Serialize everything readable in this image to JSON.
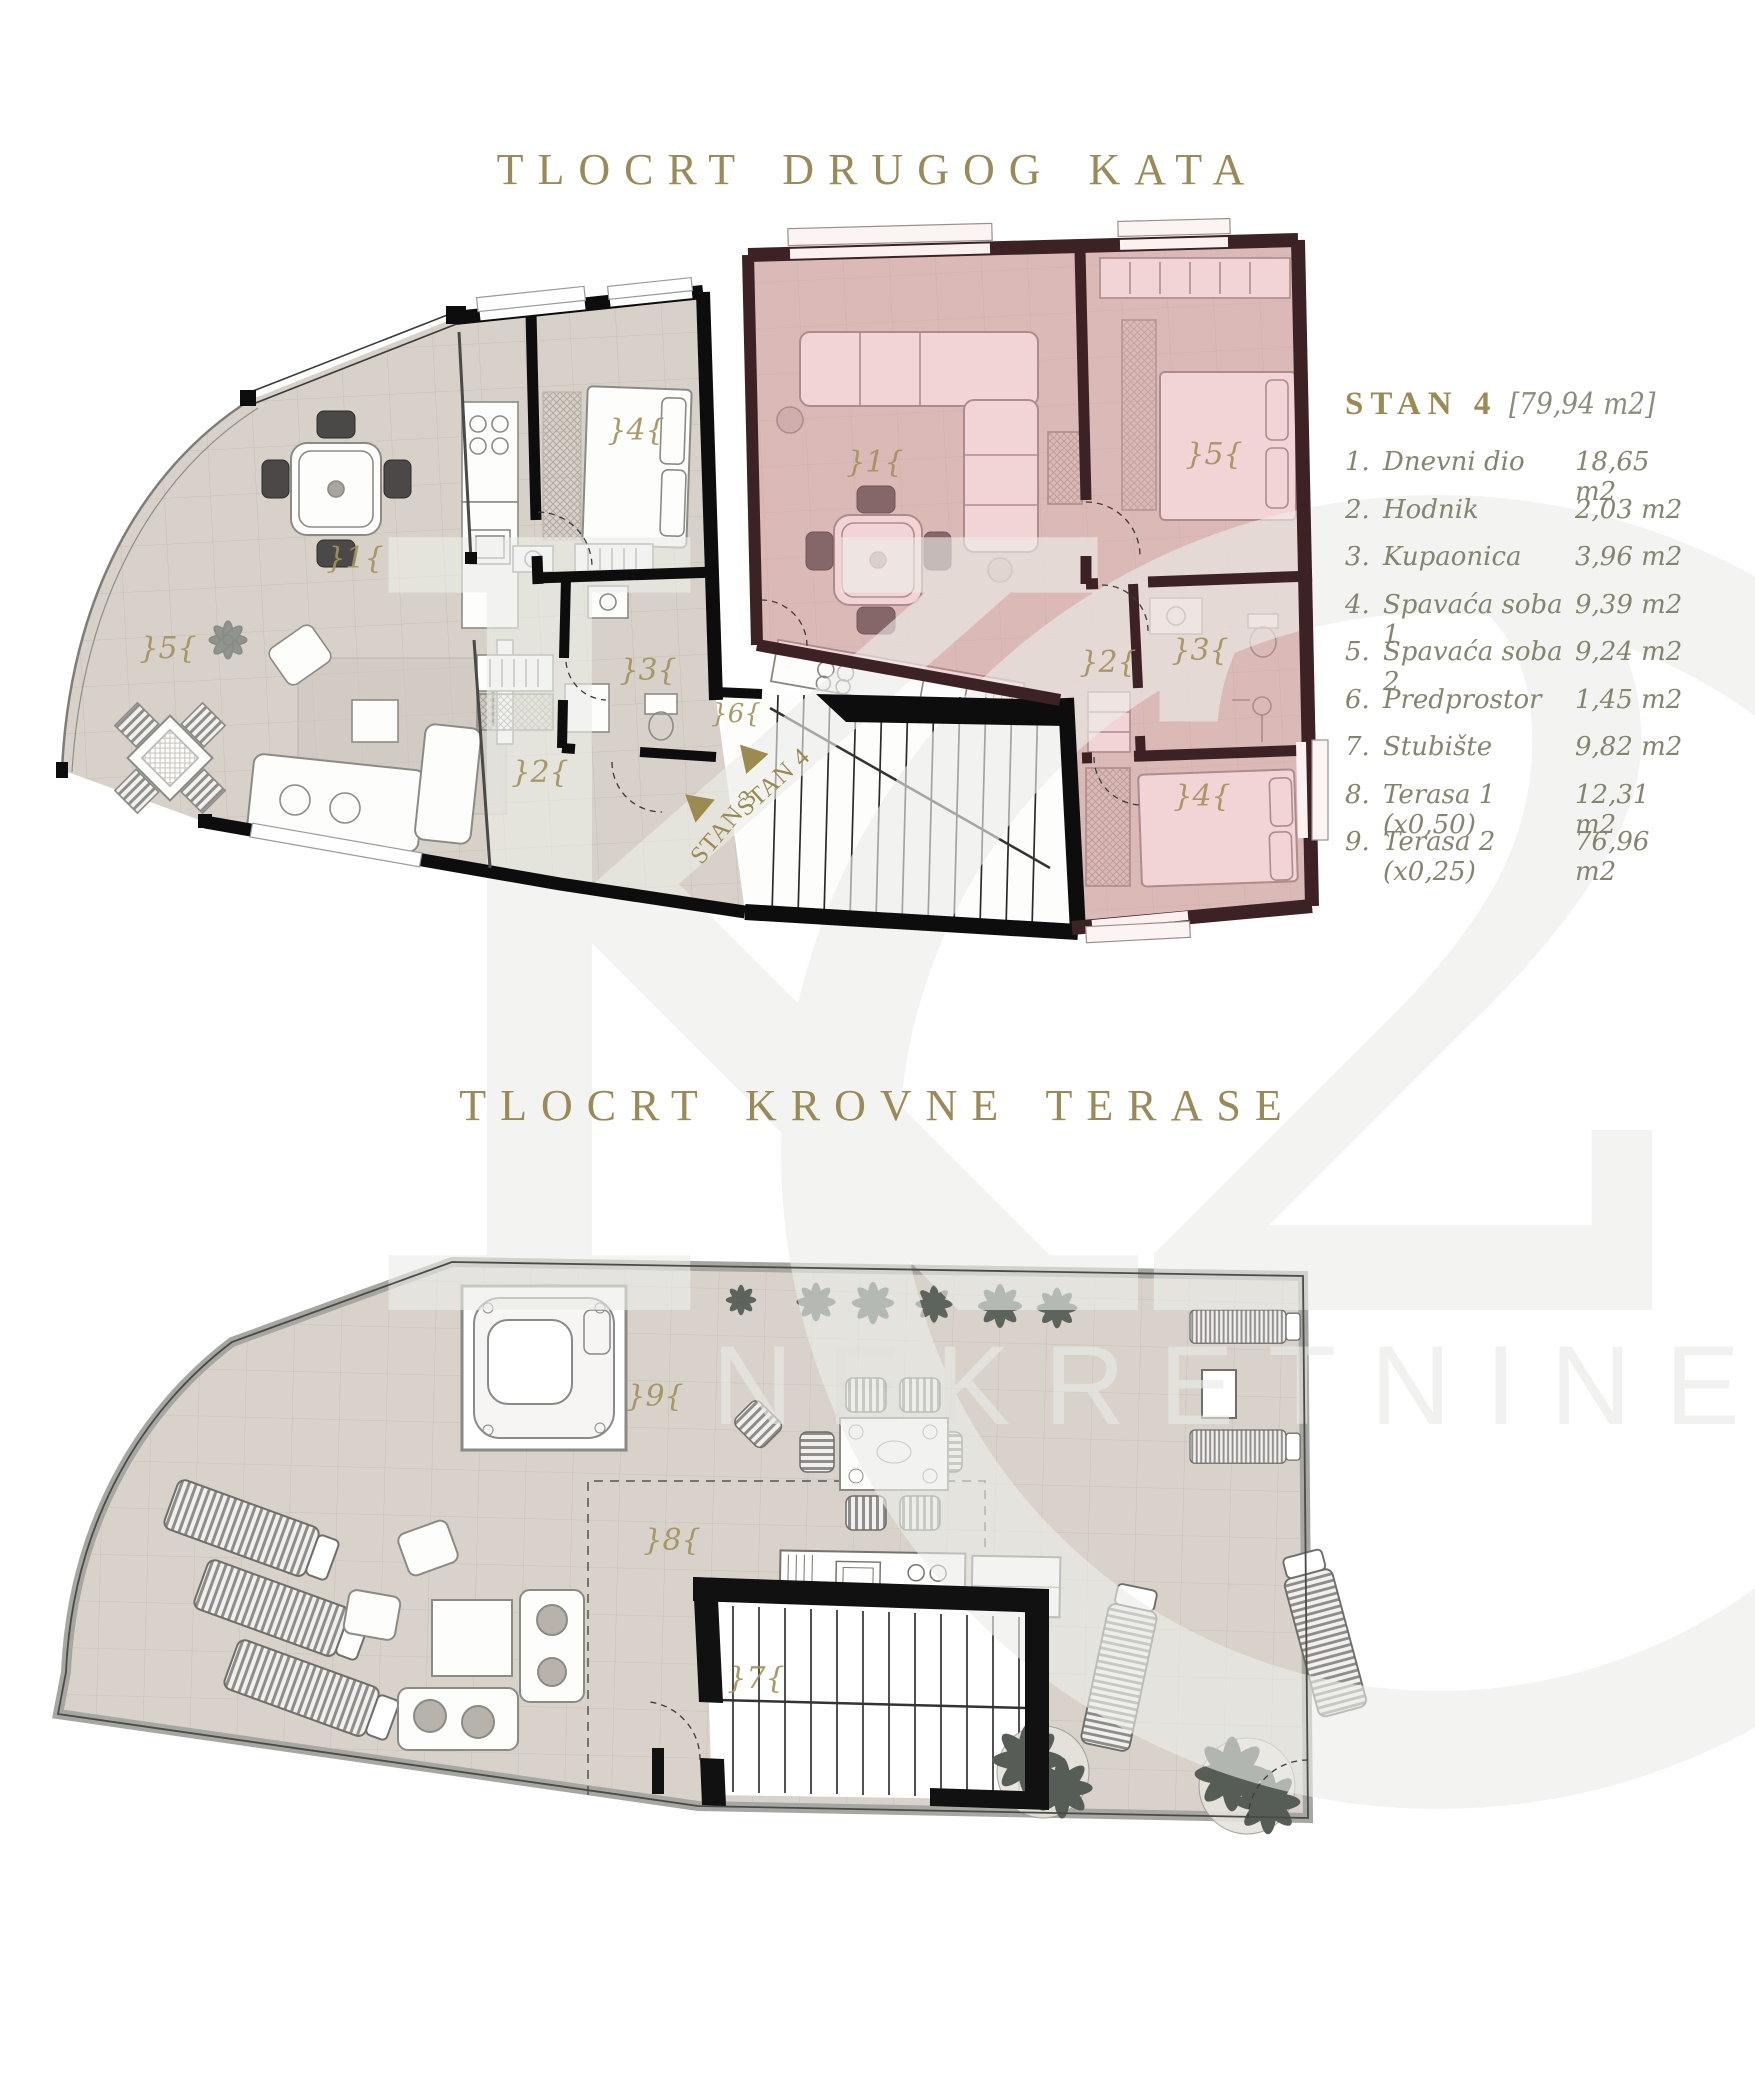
{
  "titles": {
    "floor2": "TLOCRT DRUGOG KATA",
    "roof": "TLOCRT KROVNE TERASE"
  },
  "legend": {
    "unit_label": "STAN 4",
    "unit_area": "[79,94 m2]",
    "rooms": [
      {
        "num": "1.",
        "name": "Dnevni dio",
        "area": "18,65 m2"
      },
      {
        "num": "2.",
        "name": "Hodnik",
        "area": "2,03 m2"
      },
      {
        "num": "3.",
        "name": "Kupaonica",
        "area": "3,96 m2"
      },
      {
        "num": "4.",
        "name": "Spavaća soba 1",
        "area": "9,39 m2"
      },
      {
        "num": "5.",
        "name": "Spavaća soba 2",
        "area": "9,24 m2"
      },
      {
        "num": "6.",
        "name": "Predprostor",
        "area": "1,45 m2"
      },
      {
        "num": "7.",
        "name": "Stubište",
        "area": "9,82 m2"
      },
      {
        "num": "8.",
        "name": "Terasa  1 (x0,50)",
        "area": "12,31 m2"
      },
      {
        "num": "9.",
        "name": "Terasa 2 (x0,25)",
        "area": "76,96 m2"
      }
    ]
  },
  "floor2": {
    "room_labels": [
      "}5{",
      "}1{",
      "}4{",
      "}3{",
      "}2{",
      "}6{",
      "}1{",
      "}2{",
      "}3{",
      "}5{",
      "}4{"
    ],
    "direction_labels": {
      "stan3": "STAN 3",
      "stan4": "STAN 4"
    }
  },
  "roof": {
    "room_labels": [
      "}9{",
      "}8{",
      "}7{"
    ]
  },
  "watermark": {
    "logo": "K2",
    "brand": "NEKRETNINE"
  },
  "colors": {
    "accent_gold": "#9a8a57",
    "label_gold": "#a3935d",
    "highlight_pink": "#e0969d",
    "floor_beige": "#d8d1c9",
    "wall_black": "#0d0d0d",
    "watermark_gray": "#eceee9"
  }
}
